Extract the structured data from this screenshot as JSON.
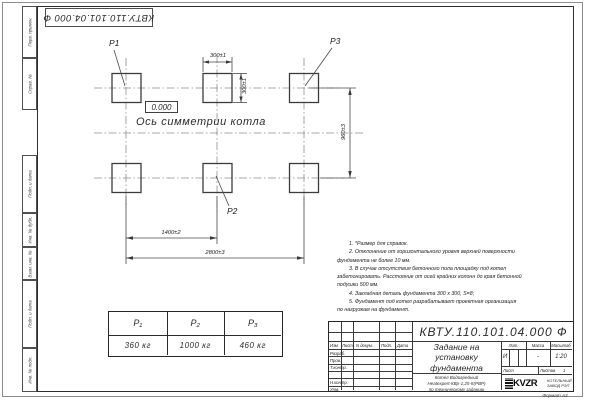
{
  "stamp": {
    "doc_number_rotated": "КВТУ.110.101.04.000  Ф"
  },
  "margin_labels": {
    "perv_primen": "Перв. примен.",
    "sprav_no": "Справ. №",
    "podp_data_1": "Подп. и дата",
    "inv_dubl": "Инв. № дубл.",
    "vzam_inv": "Взам. инв. №",
    "podp_data_2": "Подп. и дата",
    "inv_podl": "Инв. № подл."
  },
  "drawing": {
    "axis_label": "Ось симметрии котла",
    "elevation": "0.000",
    "anchors": {
      "p1": "P1",
      "p2": "P2",
      "p3": "P3"
    },
    "dims": {
      "pad_width": "300±1",
      "pad_height": "300±1",
      "row_spacing": "960±3",
      "col_spacing": "1400±2",
      "total_span": "2800±3"
    }
  },
  "notes": {
    "lines": [
      "1. *Размер для справок.",
      "2. Отклонение от горизонтального уровня верхней поверхности",
      "фундамента не более 10 мм.",
      "3. В случае отсутствия бетонного пола площадку под котел",
      "забетонировать. Расстояние от осей крайних колонн до края бетонной",
      "подушки 500 мм.",
      "4. Закладная деталь фундамента  300 х 300, S=8;",
      "5. Фундамент под котел разрабатывает проектная организация",
      "по нагрузкам на фундамент."
    ]
  },
  "load_table": {
    "headers": [
      "P₁",
      "P₂",
      "P₃"
    ],
    "values": [
      "360 кг",
      "1000 кг",
      "460 кг"
    ]
  },
  "title_block": {
    "doc_number": "КВТУ.110.101.04.000  Ф",
    "title_line1": "Задание на",
    "title_line2": "установку",
    "title_line3": "фундамента",
    "sub_line1": "Котел Водогрейный",
    "sub_line2": "Heatexpert-КВр-1,25-К(РВР)",
    "sub_line3": "по техническому заданию",
    "col_izm": "Изм",
    "col_list": "Лист",
    "col_doc": "N докум.",
    "col_podp": "Подп.",
    "col_data": "Дата",
    "row_razrab": "Разраб.",
    "row_prov": "Пров.",
    "row_tkontr": "Т.контр.",
    "row_nkontr": "Н.контр.",
    "row_utv": "Утв.",
    "lit_label": "Лит.",
    "mass_label": "Масса",
    "scale_label": "Масштаб",
    "lit_value": "И",
    "mass_value": "-",
    "scale_value": "1:20",
    "sheet_label": "Лист",
    "sheets_label": "Листов",
    "sheets_value": "1",
    "logo_text": "KVZR",
    "company_line1": "КОТЕЛЬНЫЙ",
    "company_line2": "ЗАВОД РЭП"
  },
  "footer": {
    "format_label": "Формат А3"
  }
}
